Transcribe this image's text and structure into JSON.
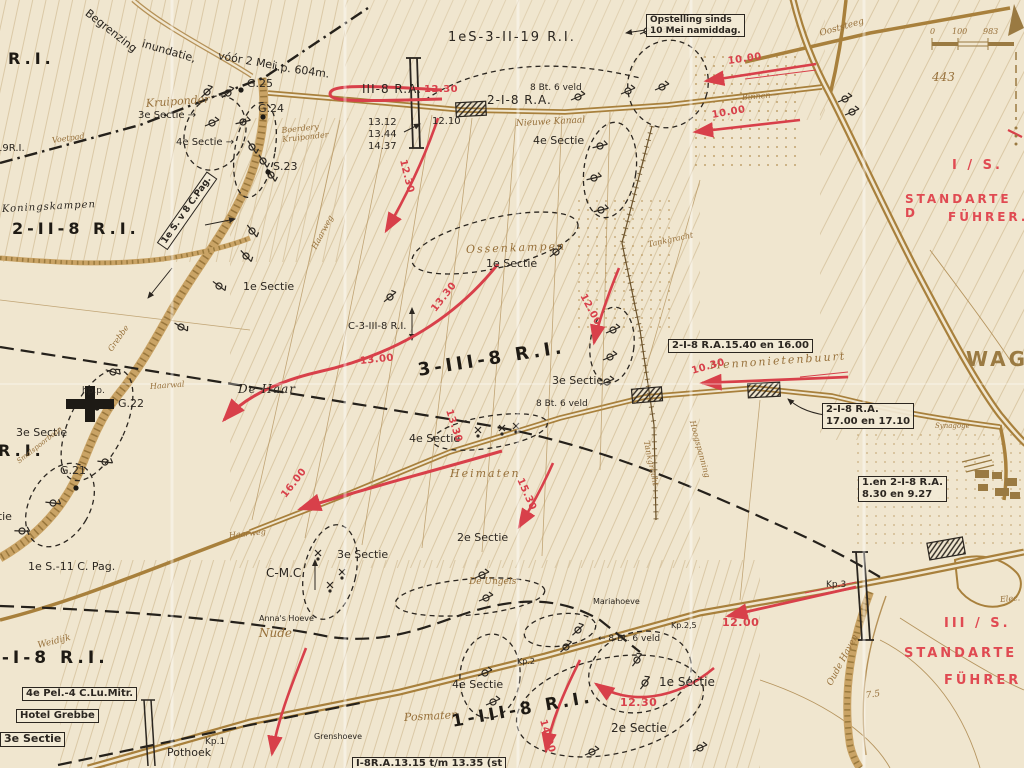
{
  "map": {
    "type": "historical-military-situation-map",
    "colors": {
      "paper": "#f0e6cf",
      "ink": "#2b2620",
      "road_brown": "#a8803c",
      "line_brown": "#b59157",
      "annotation_red": "#d8404a"
    },
    "scale_bar": {
      "ticks": [
        "0",
        "100",
        "200"
      ]
    },
    "labels": [
      {
        "name": "begrenzing-1",
        "text": "Begrenzing",
        "x": 86,
        "y": 6,
        "rot": 38,
        "size": 11
      },
      {
        "name": "begrenzing-2",
        "text": "inundatie,",
        "x": 142,
        "y": 38,
        "rot": 16,
        "size": 11
      },
      {
        "name": "begrenzing-3",
        "text": "vóór 2 Mei,",
        "x": 218,
        "y": 50,
        "rot": 10,
        "size": 11
      },
      {
        "name": "begrenzing-4",
        "text": "i.p. 604m.",
        "x": 274,
        "y": 61,
        "rot": 8,
        "size": 11
      },
      {
        "name": "unit-ri-topleft",
        "text": "R.I.",
        "x": 8,
        "y": 50,
        "style": "bk-big"
      },
      {
        "name": "unit-19ri",
        "text": "19R.I.",
        "x": -4,
        "y": 143,
        "size": 10
      },
      {
        "name": "voetpad",
        "text": "Voetpad",
        "x": 52,
        "y": 136,
        "rot": -8,
        "style": "br",
        "size": 8
      },
      {
        "name": "koningskampen",
        "text": "Koningskampen",
        "x": 2,
        "y": 204,
        "style": "bk-it",
        "size": 10,
        "rot": -3
      },
      {
        "name": "unit-2-2-8-ri",
        "text": "2-II-8 R.I.",
        "x": 12,
        "y": 220,
        "style": "bk-big"
      },
      {
        "name": "kruiponder",
        "text": "Kruiponder",
        "x": 146,
        "y": 98,
        "style": "br-md",
        "rot": -4
      },
      {
        "name": "sectie3-kruiponder",
        "text": "3e Sectie →",
        "x": 138,
        "y": 110,
        "size": 10
      },
      {
        "name": "sectie4-kruiponder",
        "text": "4e Sectie →",
        "x": 176,
        "y": 137,
        "size": 10
      },
      {
        "name": "g25",
        "text": "G.25",
        "x": 247,
        "y": 78,
        "size": 11
      },
      {
        "name": "g24",
        "text": "G.24",
        "x": 258,
        "y": 103,
        "size": 11
      },
      {
        "name": "boerdery",
        "text": "Boerdery\nKruiponder",
        "x": 282,
        "y": 126,
        "style": "br",
        "rot": -6,
        "size": 8
      },
      {
        "name": "s23",
        "text": "S.23",
        "x": 273,
        "y": 161,
        "size": 11
      },
      {
        "name": "pag-8-box",
        "text": "1e S. v 8 C.Pag.",
        "x": 162,
        "y": 240,
        "rot": -55,
        "style": "box",
        "size": 9
      },
      {
        "name": "sectie1-dike",
        "text": "1e Sectie",
        "x": 243,
        "y": 281,
        "size": 11
      },
      {
        "name": "haarweg-north",
        "text": "Haarweg",
        "x": 314,
        "y": 244,
        "rot": -62,
        "style": "br",
        "size": 8
      },
      {
        "name": "grebbe-river",
        "text": "Grebbe",
        "x": 110,
        "y": 346,
        "rot": -55,
        "style": "br",
        "size": 8
      },
      {
        "name": "hpp",
        "text": "hp.p.",
        "x": 82,
        "y": 386,
        "size": 9
      },
      {
        "name": "g22",
        "text": "G.22",
        "x": 118,
        "y": 398,
        "size": 11
      },
      {
        "name": "haarwal",
        "text": "Haarwal",
        "x": 150,
        "y": 382,
        "style": "br",
        "size": 8,
        "rot": -4
      },
      {
        "name": "de-haar",
        "text": "De Haar",
        "x": 238,
        "y": 382,
        "style": "bk-it",
        "size": 12
      },
      {
        "name": "sectie3-left",
        "text": "3e Sectie",
        "x": 16,
        "y": 427,
        "size": 11
      },
      {
        "name": "unit-ri-left",
        "text": "R.I.",
        "x": -2,
        "y": 442,
        "style": "bk-big"
      },
      {
        "name": "smalspoorbaan",
        "text": "Smalspoorbaan",
        "x": 18,
        "y": 458,
        "rot": -38,
        "style": "br",
        "size": 7
      },
      {
        "name": "g21",
        "text": "G.21",
        "x": 60,
        "y": 465,
        "size": 11
      },
      {
        "name": "sectie-partial-left",
        "text": "Sectie",
        "x": -22,
        "y": 511,
        "size": 11
      },
      {
        "name": "pag-11",
        "text": "1e S.-11 C. Pag.",
        "x": 28,
        "y": 561,
        "size": 11
      },
      {
        "name": "haarweg-south",
        "text": "Haarweg",
        "x": 229,
        "y": 531,
        "style": "br",
        "size": 8,
        "rot": -6
      },
      {
        "name": "annas-hoeve",
        "text": "Anna's Hoeve",
        "x": 259,
        "y": 614,
        "size": 8
      },
      {
        "name": "nude",
        "text": "Nude",
        "x": 259,
        "y": 626,
        "style": "br-md",
        "size": 12
      },
      {
        "name": "c-mc",
        "text": "C-M.C.",
        "x": 266,
        "y": 566,
        "size": 12
      },
      {
        "name": "sectie3-cmc",
        "text": "3e Sectie",
        "x": 337,
        "y": 549,
        "size": 11
      },
      {
        "name": "sectie2-mid",
        "text": "2e Sectie",
        "x": 457,
        "y": 532,
        "size": 11
      },
      {
        "name": "de-engels",
        "text": "De Ungels",
        "x": 469,
        "y": 577,
        "style": "br",
        "size": 9
      },
      {
        "name": "heimaten",
        "text": "Heimaten",
        "x": 450,
        "y": 468,
        "style": "br-md",
        "size": 11,
        "ls": 2
      },
      {
        "name": "sectie4-mid",
        "text": "4e Sectie",
        "x": 409,
        "y": 433,
        "size": 11
      },
      {
        "name": "ossenkampen",
        "text": "Ossenkampen",
        "x": 466,
        "y": 244,
        "style": "br-md",
        "rot": -2,
        "ls": 2
      },
      {
        "name": "sectie1-ossenkampen",
        "text": "1e Sectie",
        "x": 486,
        "y": 258,
        "size": 11
      },
      {
        "name": "c-3-3-8-ri",
        "text": "C-3-III-8 R.I.",
        "x": 348,
        "y": 321,
        "size": 10
      },
      {
        "name": "unit-3-3-8-ri",
        "text": "3-III-8 R.I.",
        "x": 418,
        "y": 360,
        "rot": -9,
        "style": "bk-big",
        "size": 18
      },
      {
        "name": "sectie3-mid",
        "text": "3e Sectie",
        "x": 552,
        "y": 375,
        "size": 11
      },
      {
        "name": "bt8-mid",
        "text": "8 Bt. 6 veld",
        "x": 536,
        "y": 399,
        "size": 9
      },
      {
        "name": "unit-1s-3-2-19-ri",
        "text": "1eS-3-II-19 R.I.",
        "x": 448,
        "y": 30,
        "size": 13,
        "ls": 2
      },
      {
        "name": "opstelling-note",
        "text": "Opstelling sinds\n10 Mei namiddag.",
        "x": 646,
        "y": 14,
        "style": "box",
        "size": 9
      },
      {
        "name": "unit-3-8-ra",
        "text": "III-8 R.A.",
        "x": 362,
        "y": 82,
        "size": 12,
        "ls": 1
      },
      {
        "name": "time-1230-a",
        "text": "12.30",
        "x": 424,
        "y": 84,
        "style": "red",
        "size": 10
      },
      {
        "name": "unit-2-1-8-ra-road",
        "text": "2-I-8 R.A.",
        "x": 487,
        "y": 93,
        "size": 12,
        "ls": 1
      },
      {
        "name": "bt8-top",
        "text": "8 Bt. 6 veld",
        "x": 530,
        "y": 83,
        "size": 9
      },
      {
        "name": "time-1312",
        "text": "13.12",
        "x": 368,
        "y": 117,
        "size": 10
      },
      {
        "name": "time-1344",
        "text": "13.44",
        "x": 368,
        "y": 129,
        "size": 10
      },
      {
        "name": "time-1437",
        "text": "14.37",
        "x": 368,
        "y": 141,
        "size": 10
      },
      {
        "name": "time-1210",
        "text": "12.10",
        "x": 432,
        "y": 116,
        "size": 10
      },
      {
        "name": "nieuwe-kanaal",
        "text": "Nieuwe Kanaal",
        "x": 516,
        "y": 119,
        "style": "br",
        "rot": -3,
        "size": 9
      },
      {
        "name": "sectie4-top",
        "text": "4e Sectie",
        "x": 533,
        "y": 135,
        "size": 11
      },
      {
        "name": "ooststeeg",
        "text": "Ooststeeg",
        "x": 820,
        "y": 29,
        "style": "br",
        "rot": -16,
        "size": 9
      },
      {
        "name": "binnen",
        "text": "Binnen—",
        "x": 742,
        "y": 93,
        "style": "br",
        "rot": -5,
        "size": 8
      },
      {
        "name": "time-1000-a",
        "text": "10.00",
        "x": 728,
        "y": 56,
        "style": "red",
        "rot": -8
      },
      {
        "name": "time-1000-b",
        "text": "10.00",
        "x": 712,
        "y": 110,
        "style": "red",
        "rot": -10
      },
      {
        "name": "unit-i-s-red",
        "text": "I / S.",
        "x": 952,
        "y": 158,
        "style": "red-big"
      },
      {
        "name": "standarte-north",
        "text": "STANDARTE D",
        "x": 905,
        "y": 192,
        "style": "red-big",
        "size": 12
      },
      {
        "name": "fuhrer-north",
        "text": "FÜHRER.",
        "x": 948,
        "y": 210,
        "style": "red-big",
        "size": 12
      },
      {
        "name": "height-443",
        "text": "443",
        "x": 932,
        "y": 70,
        "style": "br-md",
        "size": 12
      },
      {
        "name": "wageningen",
        "text": "WAGEN",
        "x": 966,
        "y": 348,
        "style": "br-big"
      },
      {
        "name": "note-1540",
        "text": "2-I-8 R.A.15.40 en 16.00",
        "x": 668,
        "y": 339,
        "style": "box",
        "size": 10
      },
      {
        "name": "mennonietenbuurt",
        "text": "Mennonietenbuurt",
        "x": 710,
        "y": 360,
        "style": "br-md",
        "rot": -4,
        "ls": 2
      },
      {
        "name": "time-1030",
        "text": "10.30",
        "x": 692,
        "y": 366,
        "style": "red",
        "rot": -16
      },
      {
        "name": "note-1700",
        "text": "2-I-8 R.A.\n17.00 en 17.10",
        "x": 822,
        "y": 403,
        "style": "box",
        "size": 10
      },
      {
        "name": "synagoge",
        "text": "Synagoge",
        "x": 935,
        "y": 422,
        "style": "br",
        "size": 7
      },
      {
        "name": "note-830",
        "text": "1.en 2-I-8 R.A.\n8.30 en 9.27",
        "x": 858,
        "y": 476,
        "style": "box",
        "size": 10
      },
      {
        "name": "tankgracht-north",
        "text": "Tankgracht",
        "x": 648,
        "y": 240,
        "style": "br",
        "rot": -12,
        "size": 8
      },
      {
        "name": "tankgracht-south",
        "text": "Tankgracht",
        "x": 646,
        "y": 436,
        "style": "br",
        "rot": 78,
        "size": 8
      },
      {
        "name": "hoogspanning",
        "text": "Hoogspanning",
        "x": 692,
        "y": 416,
        "style": "br",
        "rot": 75,
        "size": 8
      },
      {
        "name": "time-1200-mid",
        "text": "12.00",
        "x": 582,
        "y": 289,
        "style": "red",
        "rot": 62
      },
      {
        "name": "time-1330-a",
        "text": "13.30",
        "x": 434,
        "y": 305,
        "style": "red",
        "rot": -52
      },
      {
        "name": "time-1300",
        "text": "13.00",
        "x": 360,
        "y": 356,
        "style": "red",
        "rot": -6
      },
      {
        "name": "time-1330-b",
        "text": "13.30",
        "x": 448,
        "y": 404,
        "style": "red",
        "rot": 72
      },
      {
        "name": "time-1230-b",
        "text": "12.30",
        "x": 402,
        "y": 154,
        "style": "red",
        "rot": 76
      },
      {
        "name": "time-1600",
        "text": "16.00",
        "x": 284,
        "y": 491,
        "style": "red",
        "rot": -52
      },
      {
        "name": "time-1530",
        "text": "15.30",
        "x": 519,
        "y": 473,
        "style": "red",
        "rot": 66
      },
      {
        "name": "unit-1-1-8-ri",
        "text": "1-I-8 R.I.",
        "x": -14,
        "y": 648,
        "style": "bk-big",
        "size": 17
      },
      {
        "name": "weidijk",
        "text": "Weidijk",
        "x": 38,
        "y": 641,
        "style": "br",
        "rot": -14,
        "size": 9
      },
      {
        "name": "note-pel",
        "text": "4e Pel.-4 C.Lu.Mitr.",
        "x": 22,
        "y": 687,
        "style": "box",
        "size": 10
      },
      {
        "name": "hotel-grebbe",
        "text": "Hotel Grebbe",
        "x": 16,
        "y": 709,
        "style": "box",
        "size": 10
      },
      {
        "name": "sectie3-bottomleft",
        "text": "3e Sectie",
        "x": 0,
        "y": 732,
        "style": "box",
        "size": 11
      },
      {
        "name": "kp1",
        "text": "Kp.1",
        "x": 205,
        "y": 737,
        "size": 9
      },
      {
        "name": "pothoek",
        "text": "Pothoek",
        "x": 167,
        "y": 747,
        "size": 11
      },
      {
        "name": "grenshoeve",
        "text": "Grenshoeve",
        "x": 314,
        "y": 732,
        "size": 8
      },
      {
        "name": "note-i8ra-bottom",
        "text": "I-8R.A.13.15 t/m 13.35 (st",
        "x": 352,
        "y": 757,
        "style": "box",
        "size": 10
      },
      {
        "name": "posmaten",
        "text": "Posmaten",
        "x": 404,
        "y": 712,
        "style": "br-md",
        "rot": -3
      },
      {
        "name": "unit-1-3-8-ri",
        "text": "1-III-8 R.I.",
        "x": 452,
        "y": 712,
        "rot": -10,
        "style": "bk-big",
        "size": 17
      },
      {
        "name": "sectie4-bottom",
        "text": "4e Sectie",
        "x": 452,
        "y": 679,
        "size": 11
      },
      {
        "name": "time-1400",
        "text": "14.00",
        "x": 542,
        "y": 714,
        "style": "red",
        "rot": 74
      },
      {
        "name": "kp2",
        "text": "Kp.2",
        "x": 517,
        "y": 657,
        "size": 8
      },
      {
        "name": "mariahoeve",
        "text": "Mariahoeve",
        "x": 593,
        "y": 597,
        "size": 8
      },
      {
        "name": "bt8-bottom",
        "text": "← 8 Bt. 6 veld",
        "x": 598,
        "y": 634,
        "size": 9
      },
      {
        "name": "sectie1-bottom",
        "text": "1e Sectie",
        "x": 659,
        "y": 675,
        "size": 12
      },
      {
        "name": "time-1230-c",
        "text": "12.30",
        "x": 620,
        "y": 697,
        "style": "red",
        "size": 11
      },
      {
        "name": "sectie2-bottom",
        "text": "2e Sectie",
        "x": 611,
        "y": 721,
        "size": 12
      },
      {
        "name": "kp25",
        "text": "Kp.2,5",
        "x": 671,
        "y": 621,
        "size": 8
      },
      {
        "name": "time-1200-b",
        "text": "12.00",
        "x": 722,
        "y": 617,
        "style": "red",
        "size": 11
      },
      {
        "name": "kp3",
        "text": "Kp.3",
        "x": 826,
        "y": 580,
        "size": 9
      },
      {
        "name": "oude-haven",
        "text": "Oude Haven",
        "x": 830,
        "y": 680,
        "style": "br",
        "rot": -62,
        "size": 9
      },
      {
        "name": "height-75",
        "text": "7.5",
        "x": 866,
        "y": 691,
        "style": "br",
        "size": 9,
        "rot": -8
      },
      {
        "name": "elec",
        "text": "Elec.",
        "x": 1000,
        "y": 595,
        "style": "br",
        "size": 8,
        "rot": -5
      },
      {
        "name": "unit-iii-s-red",
        "text": "III / S.",
        "x": 944,
        "y": 616,
        "style": "red-big"
      },
      {
        "name": "standarte-south",
        "text": "STANDARTE",
        "x": 904,
        "y": 646,
        "style": "red-big"
      },
      {
        "name": "fuhrer-south",
        "text": "FÜHRER",
        "x": 944,
        "y": 673,
        "style": "red-big"
      },
      {
        "name": "scale-0",
        "text": "0",
        "x": 930,
        "y": 27,
        "style": "br",
        "size": 8
      },
      {
        "name": "scale-100",
        "text": "100",
        "x": 952,
        "y": 27,
        "style": "br",
        "size": 8
      },
      {
        "name": "scale-200",
        "text": "983",
        "x": 983,
        "y": 27,
        "style": "br",
        "size": 8
      }
    ]
  }
}
